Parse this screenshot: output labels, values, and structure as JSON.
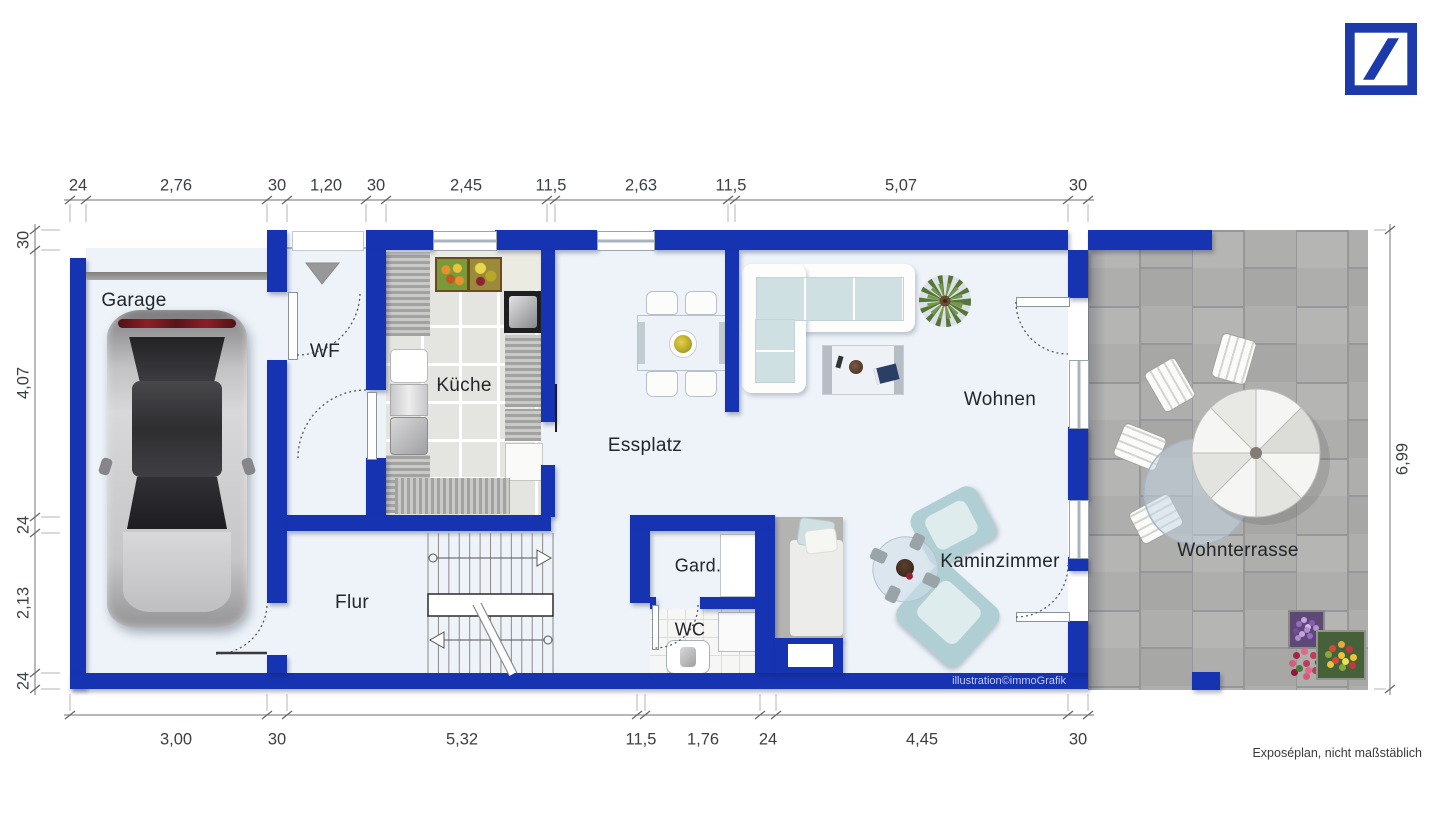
{
  "branding": {
    "logo_icon": "deutsche-bank-logo"
  },
  "rooms": {
    "garage": "Garage",
    "wf": "WF",
    "kueche": "Küche",
    "essplatz": "Essplatz",
    "wohnen": "Wohnen",
    "kaminzimmer": "Kaminzimmer",
    "gard": "Gard.",
    "wc": "WC",
    "flur": "Flur",
    "wohnterrasse": "Wohnterrasse"
  },
  "dimensions": {
    "top": [
      "24",
      "2,76",
      "30",
      "1,20",
      "30",
      "2,45",
      "11,5",
      "2,63",
      "11,5",
      "5,07",
      "30"
    ],
    "bottom": [
      "3,00",
      "30",
      "5,32",
      "11,5",
      "1,76",
      "24",
      "4,45",
      "30"
    ],
    "left": [
      "30",
      "4,07",
      "24",
      "2,13",
      "24"
    ],
    "right": [
      "6,99"
    ]
  },
  "footer": {
    "credit": "illustration©immoGrafik",
    "disclaimer": "Exposéplan, nicht maßstäblich"
  },
  "icons": {
    "entry": "entrance-arrow",
    "stairs": "staircase",
    "car": "car-top-view",
    "parasol": "parasol"
  },
  "colors": {
    "wall": "#1633b2",
    "floor": "#edf3f9",
    "terrace": "#aeaeac",
    "logo": "#1c3aa9"
  }
}
